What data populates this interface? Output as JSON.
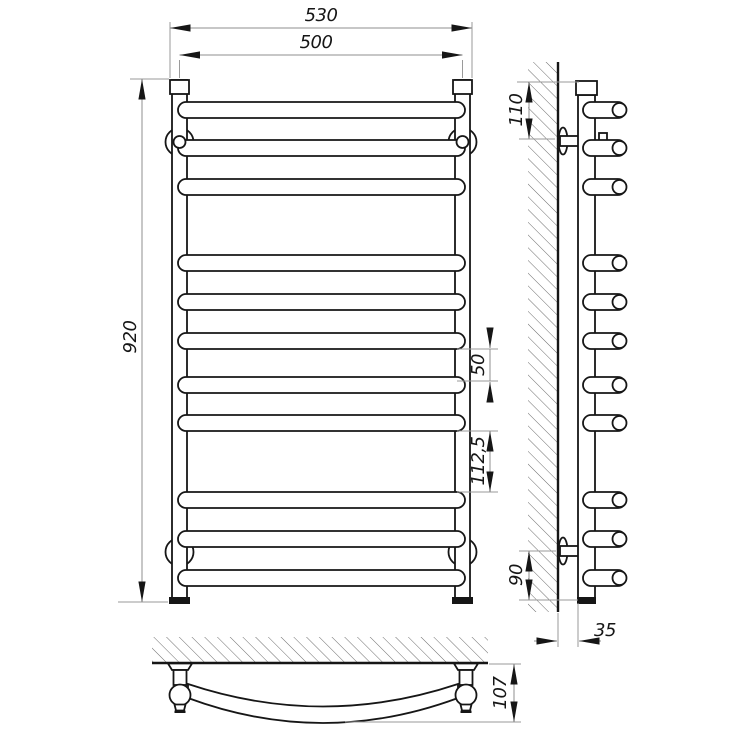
{
  "drawing": {
    "type": "technical-drawing",
    "subject": "ladder-towel-rail",
    "colors": {
      "background": "#ffffff",
      "outline": "#161616",
      "dimension_lines": "#8f8f8f",
      "dimension_text": "#161616"
    },
    "front_view": {
      "rung_count": 11,
      "dims": {
        "overall_width": "530",
        "axis_width": "500",
        "height": "920",
        "rung_gap": "50",
        "group_gap": "112,5"
      }
    },
    "side_view": {
      "rung_count": 11,
      "dims": {
        "top_bracket_offset": "110",
        "bottom_bracket_offset": "90",
        "wall_clearance": "35"
      }
    },
    "bottom_view": {
      "dims": {
        "depth": "107"
      }
    }
  }
}
